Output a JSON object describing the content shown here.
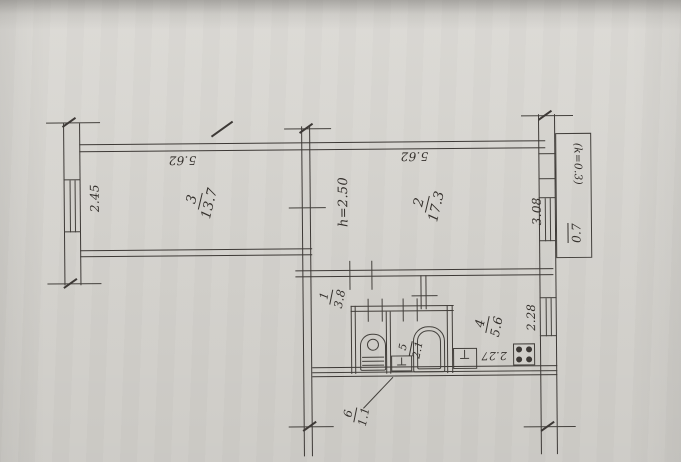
{
  "plan": {
    "rooms": [
      {
        "number": "3",
        "area": "13.7"
      },
      {
        "number": "2",
        "area": "17.3"
      },
      {
        "number": "1",
        "area": "3.8"
      },
      {
        "number": "4",
        "area": "5.6"
      },
      {
        "number": "5",
        "area": "2.1"
      },
      {
        "number": "6",
        "area": "1.1"
      }
    ],
    "dimensions": {
      "room3_width": "5.62",
      "room3_depth": "2.45",
      "room2_width": "5.62",
      "room2_depth": "3.08",
      "ceiling_height": "h=2.50",
      "kitchen_width": "2.27",
      "kitchen_depth": "2.28",
      "balcony_coefficient": "(k=0.3)",
      "balcony_area": "0.7"
    }
  }
}
